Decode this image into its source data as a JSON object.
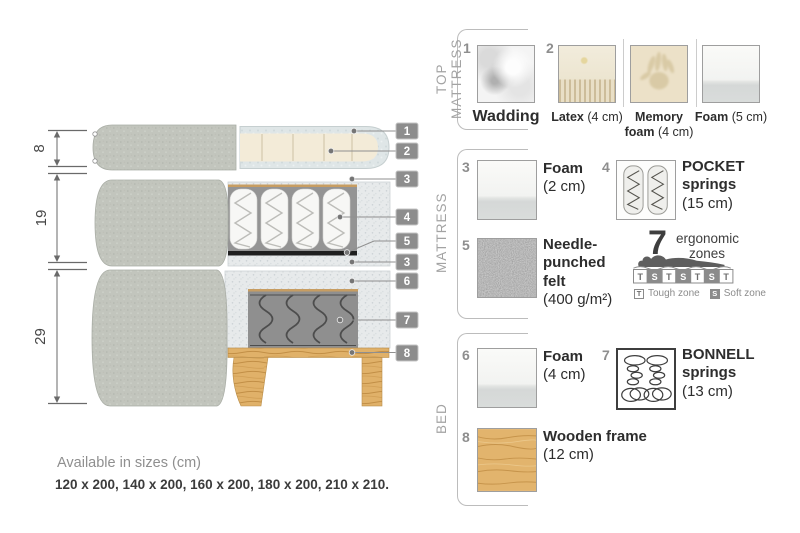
{
  "diagram": {
    "dims": [
      {
        "value": "8"
      },
      {
        "value": "19"
      },
      {
        "value": "29"
      }
    ],
    "labels": [
      "1",
      "2",
      "3",
      "4",
      "5",
      "3",
      "6",
      "7",
      "8"
    ]
  },
  "panel": {
    "top_mattress": {
      "title": "TOP MATTRESS",
      "num1": "1",
      "wadding": {
        "name": "Wadding"
      },
      "num2": "2",
      "latex": {
        "name": "Latex",
        "size": "(4 cm)"
      },
      "memory": {
        "name_l1": "Memory",
        "name_l2": "foam",
        "size": "(4 cm)"
      },
      "foam5": {
        "name": "Foam",
        "size": "(5 cm)"
      }
    },
    "mattress": {
      "title": "MATTRESS",
      "foam2": {
        "num": "3",
        "name": "Foam",
        "size": "(2 cm)"
      },
      "pocket": {
        "num": "4",
        "name_l1": "POCKET",
        "name_l2": "springs",
        "size": "(15 cm)"
      },
      "felt": {
        "num": "5",
        "name_l1": "Needle-",
        "name_l2": "punched",
        "name_l3": "felt",
        "size": "(400 g/m²)"
      },
      "ergonomic": {
        "number": "7",
        "label_l1": "ergonomic",
        "label_l2": "zones",
        "zones": [
          "T",
          "S",
          "T",
          "S",
          "T",
          "S",
          "T"
        ],
        "legend_t_key": "T",
        "legend_t": "Tough zone",
        "legend_s_key": "S",
        "legend_s": "Soft zone"
      }
    },
    "bed": {
      "title": "BED",
      "foam4": {
        "num": "6",
        "name": "Foam",
        "size": "(4 cm)"
      },
      "bonnell": {
        "num": "7",
        "name_l1": "BONNELL",
        "name_l2": "springs",
        "size": "(13 cm)"
      },
      "frame": {
        "num": "8",
        "name": "Wooden frame",
        "size": "(12 cm)"
      }
    }
  },
  "sizes": {
    "heading": "Available in sizes (cm)",
    "values": "120 x 200, 140 x 200, 160 x 200, 180 x 200, 210 x 210."
  },
  "colors": {
    "wood": "#e0b169",
    "fabric_gray": "#c2c5bd",
    "tag_gray": "#8d8d8d",
    "text_dark": "#3b3b3b",
    "text_gray": "#8f8f8f"
  }
}
